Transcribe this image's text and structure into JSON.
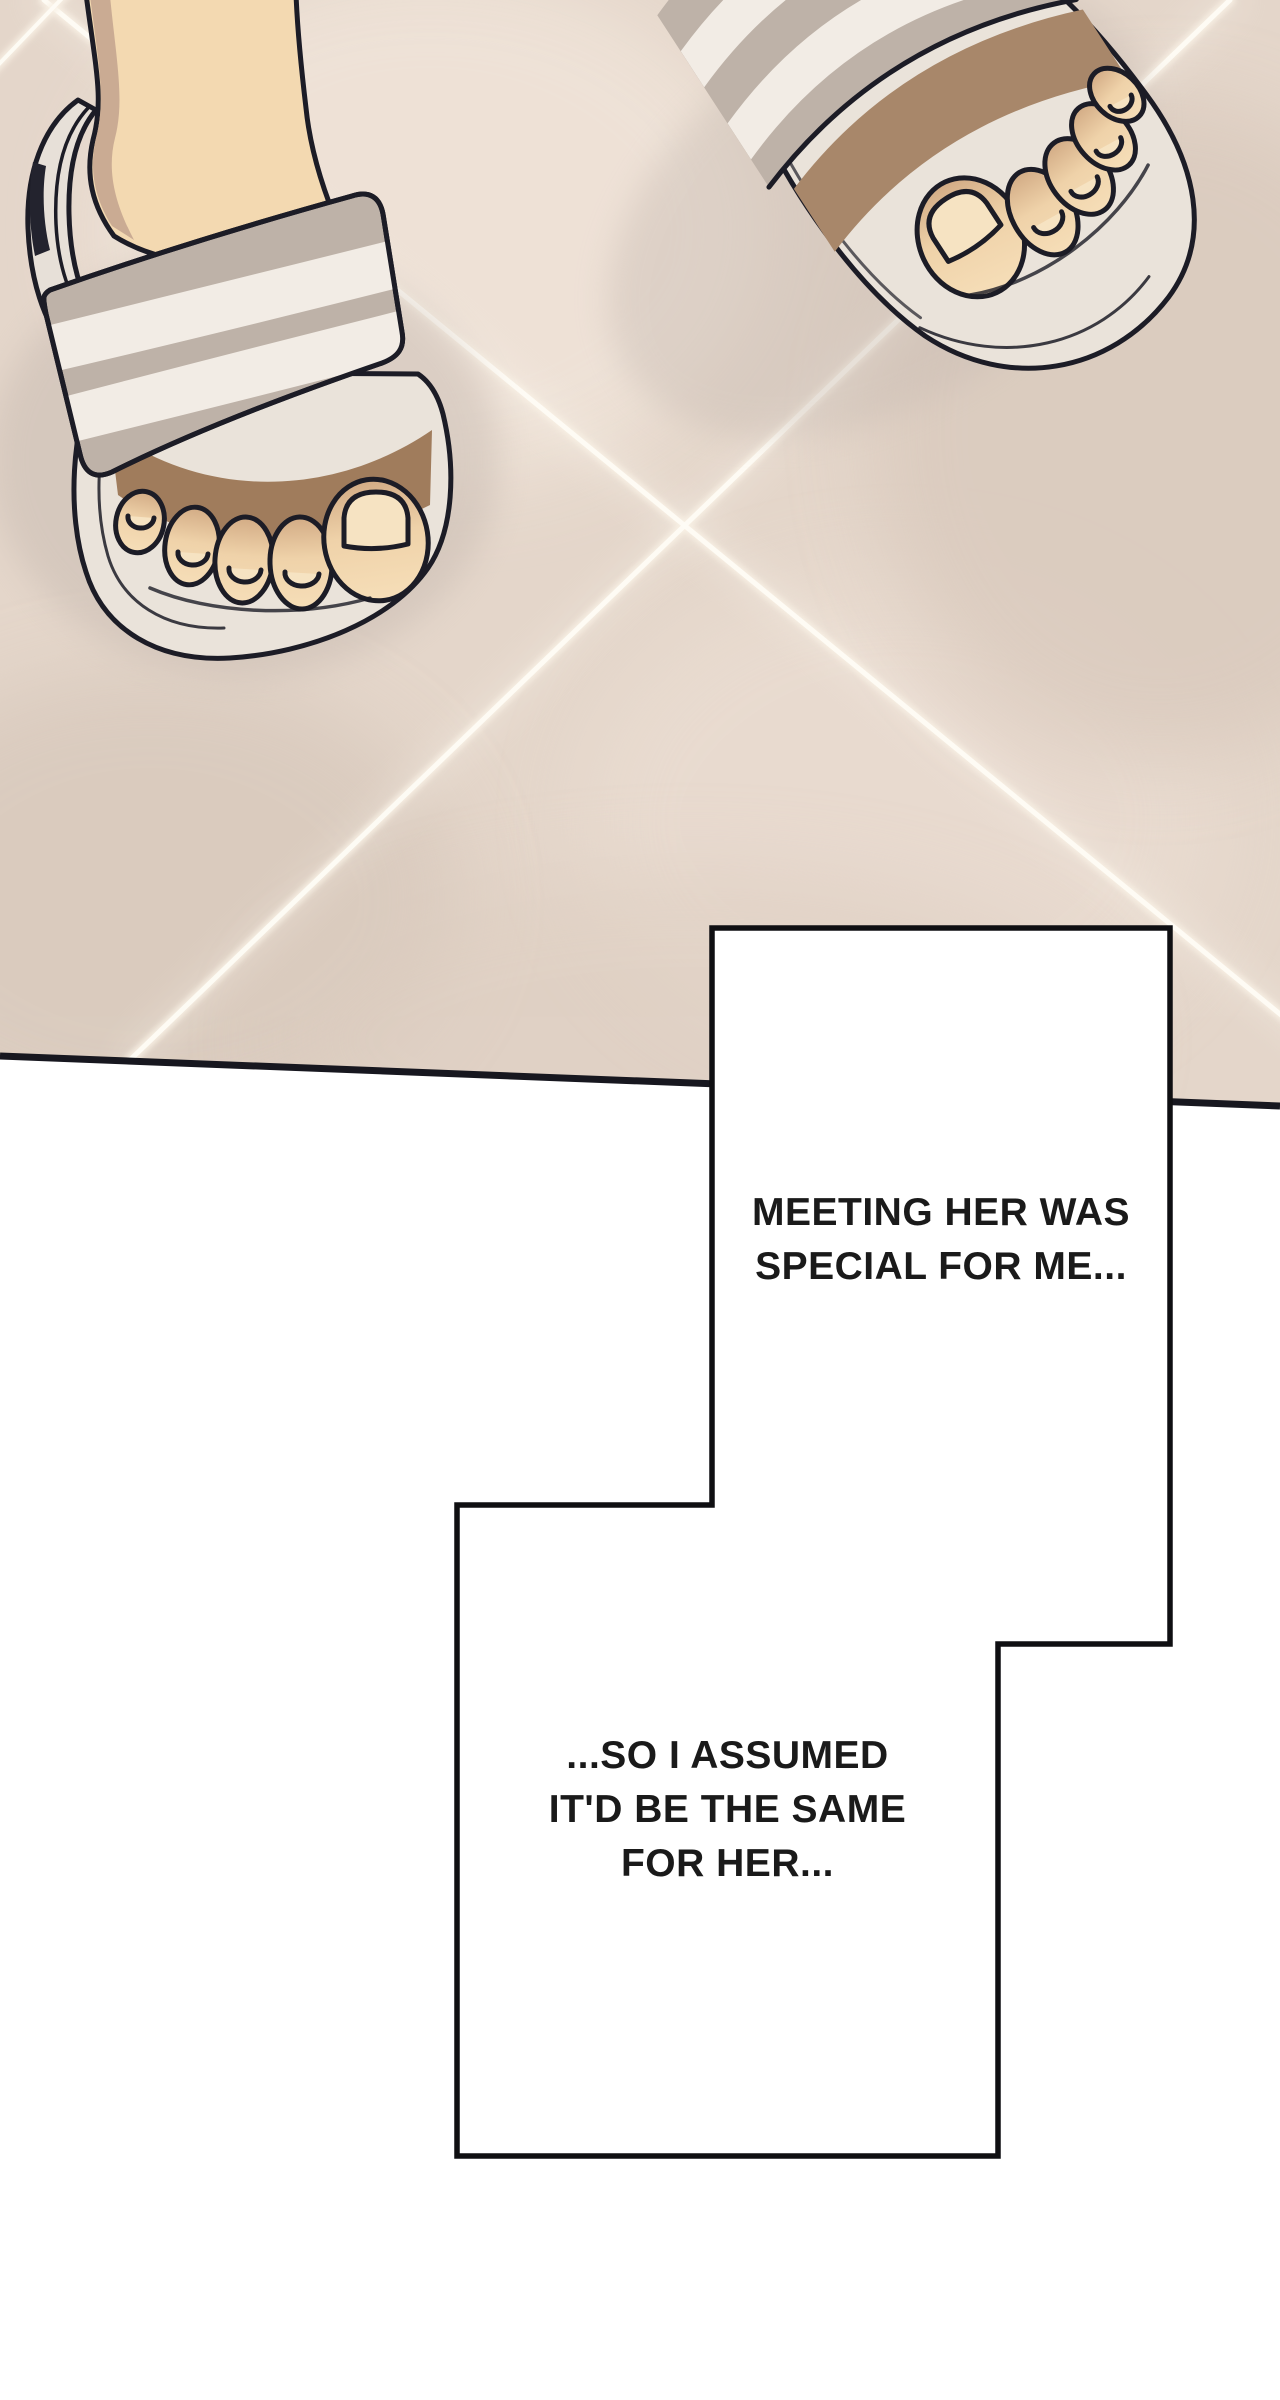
{
  "page": {
    "width": 1280,
    "height": 2400,
    "background": "#ffffff"
  },
  "artwork": {
    "scene": "overhead view of two feet wearing striped slide sandals standing on a beige tiled floor crossed by bright light streaks",
    "colors": {
      "floor": "#e4d6ca",
      "floor_light": "#efe3d8",
      "floor_shadow": "#d6c7ba",
      "grout_light": "#f8f0e4",
      "streak_white": "#fdfaf2",
      "outline": "#1c1c26",
      "skin": "#f3d9b1",
      "skin_shadow": "#c2a28e",
      "under_strap_shadow": "#a07c5c",
      "strap_gray": "#beb2a8",
      "stripe_white": "#f2ece5",
      "sole": "#eae3da",
      "floor_edge_line": "#17171f"
    }
  },
  "panels": {
    "border_color": "#0f0f12",
    "fill_color": "#ffffff",
    "caption1": {
      "lines": [
        "MEETING HER WAS",
        "SPECIAL FOR ME..."
      ]
    },
    "caption2": {
      "lines": [
        "...SO I ASSUMED",
        "IT'D BE THE SAME",
        "FOR HER..."
      ]
    }
  }
}
